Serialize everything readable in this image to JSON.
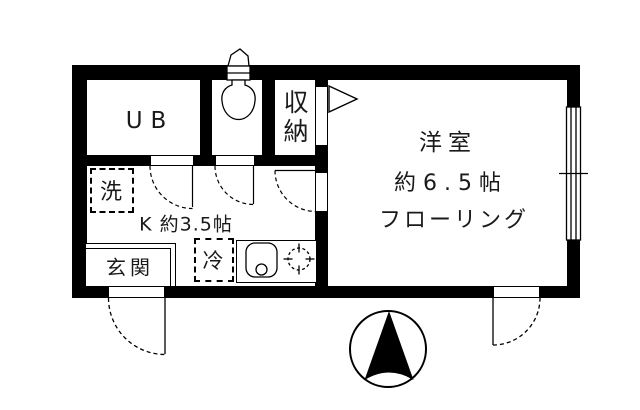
{
  "plan": {
    "type": "floor-plan",
    "labels": {
      "unit_bath": "UB",
      "storage": "収納",
      "western_room_name": "洋室",
      "western_room_size": "約6.5帖",
      "western_room_floor": "フローリング",
      "kitchen": "K 約3.5帖",
      "entrance": "玄関",
      "washing_machine": "洗",
      "refrigerator": "冷"
    },
    "icons": {
      "compass": "north-arrow-in-circle",
      "toilet": "toilet-tank-and-bowl",
      "sink": "kitchen-sink-with-drain",
      "burner": "stove-burner-crosshair",
      "closet_door": "triangle-door-marker",
      "window": "sliding-window-double-line"
    },
    "colors": {
      "wall": "#000000",
      "background": "#ffffff",
      "line": "#1a1a1a"
    }
  }
}
